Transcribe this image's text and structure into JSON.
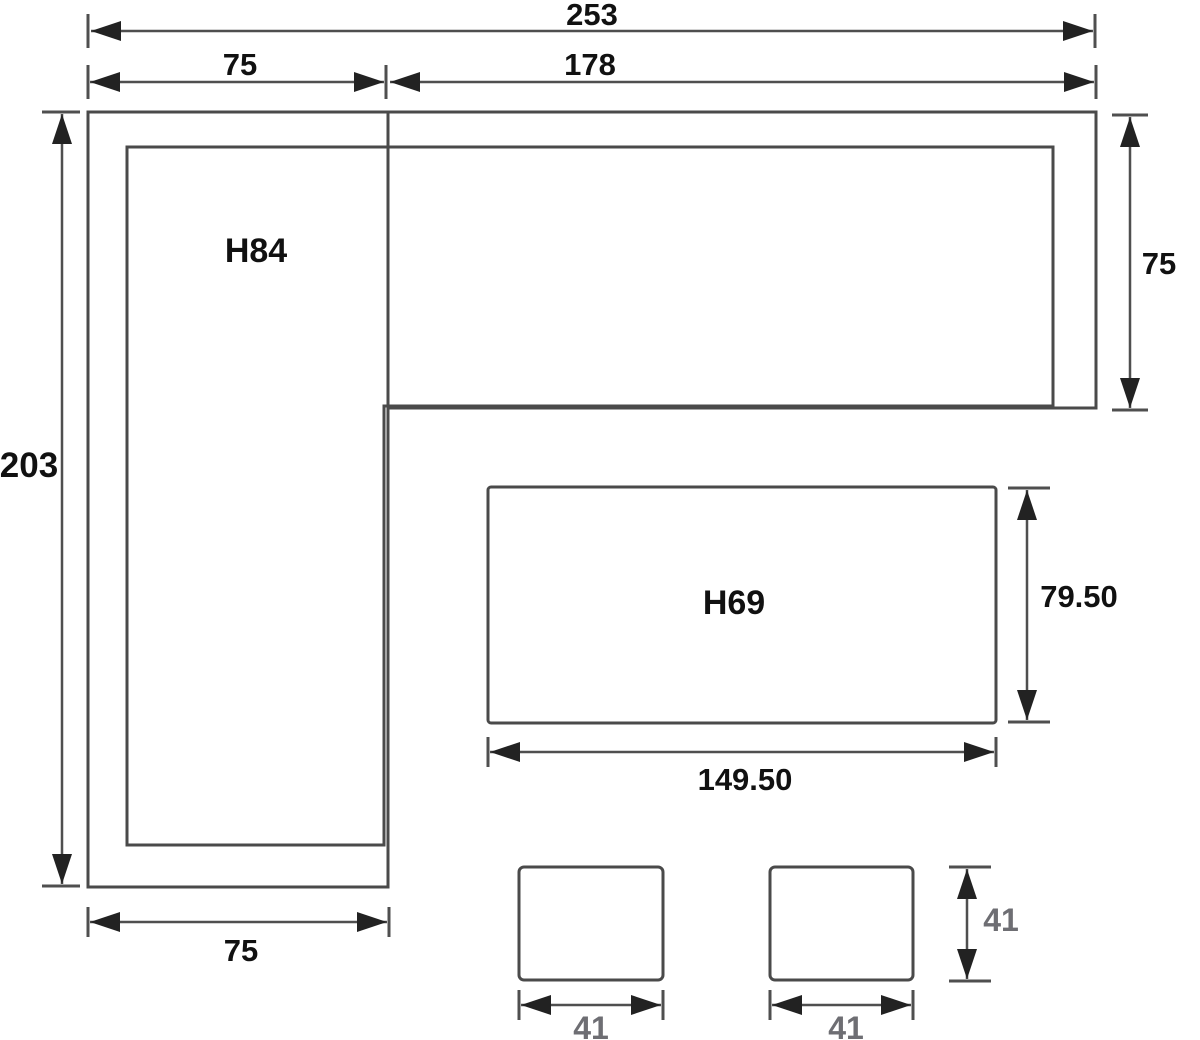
{
  "page": {
    "description": "Top-view dimension drawing of an L-shaped corner sofa set with coffee table and two stools",
    "background": "#ffffff"
  },
  "colors": {
    "line": "#4a4a4a",
    "dimension_line": "#4f4f4f",
    "text": "#111111",
    "muted_text": "#6e6e73",
    "arrow": "#222222"
  },
  "parts": {
    "left_section_label": "H84",
    "table_label": "H69"
  },
  "dimensions": {
    "overall_width": "253",
    "top_left_width": "75",
    "top_right_width": "178",
    "overall_depth": "203",
    "right_section_depth": "75",
    "left_section_width": "75",
    "table_width": "149.50",
    "table_depth": "79.50",
    "stool_left_width": "41",
    "stool_right_width": "41",
    "stool_depth": "41"
  }
}
